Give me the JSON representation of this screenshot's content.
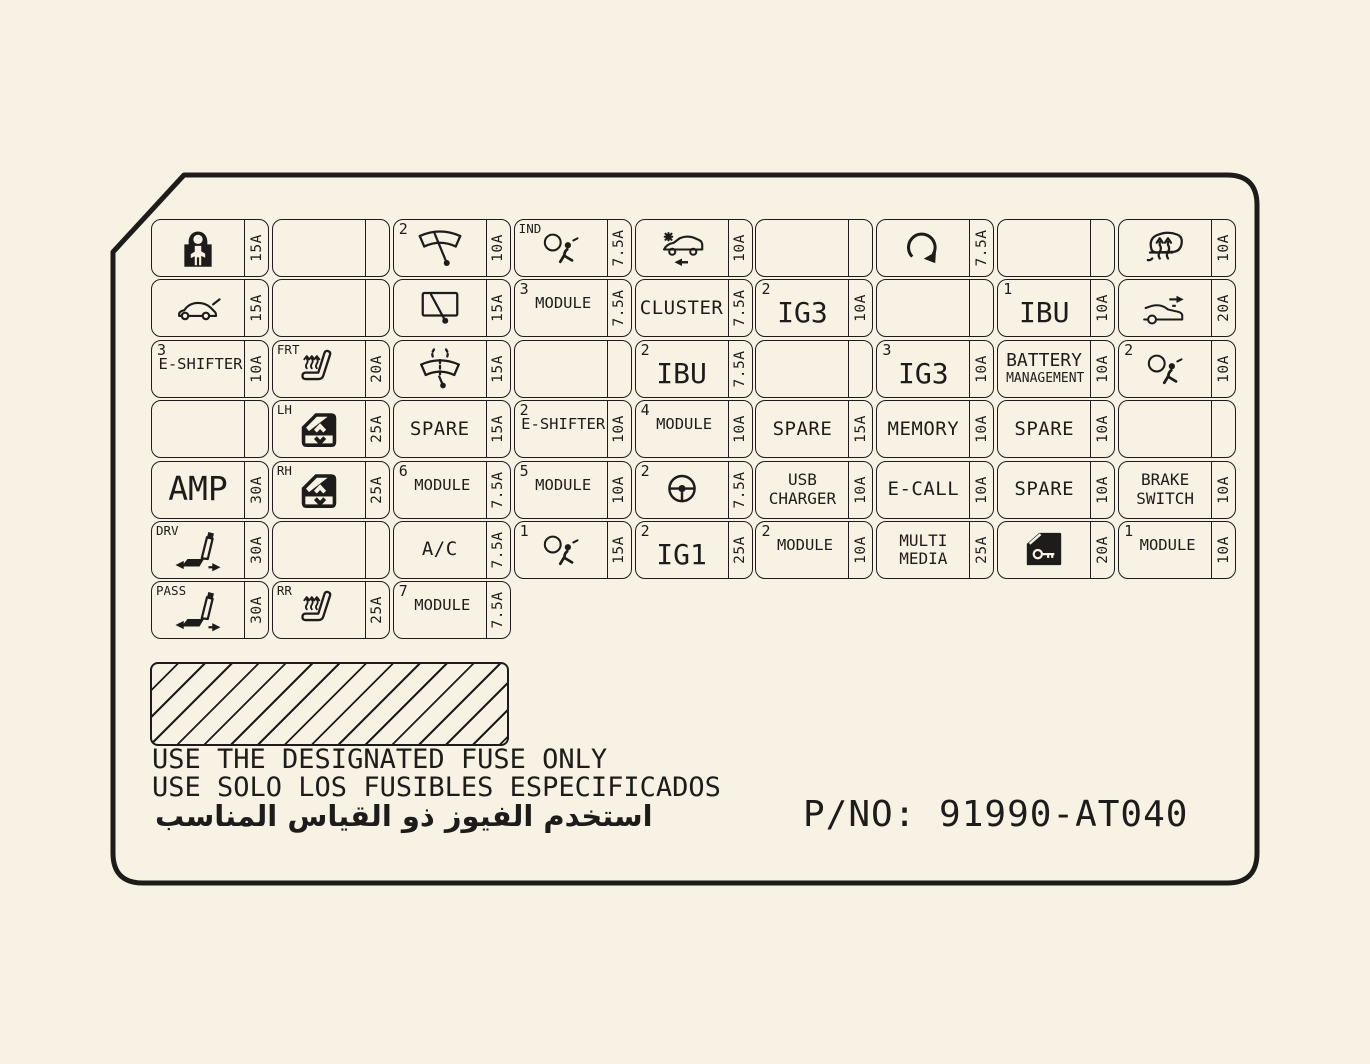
{
  "colors": {
    "background": "#f7f2e3",
    "ink": "#1d1c1a"
  },
  "notes": {
    "en": "USE THE DESIGNATED FUSE ONLY",
    "es": "USE SOLO LOS FUSIBLES ESPECIFICADOS",
    "ar": "استخدم الفيوز ذو القياس المناسب",
    "pno": "P/NO: 91990-AT040"
  },
  "grid": {
    "rows": [
      [
        {
          "icon": "child-lock",
          "amp": "15A"
        },
        {},
        {
          "icon": "wiper-front",
          "corner": "2",
          "amp": "10A"
        },
        {
          "icon": "airbag",
          "tag": "IND",
          "amp": "7.5A"
        },
        {
          "icon": "car-crash",
          "amp": "10A"
        },
        {},
        {
          "icon": "circular-arrow",
          "amp": "7.5A"
        },
        {},
        {
          "icon": "defrost-rear",
          "amp": "10A"
        }
      ],
      [
        {
          "icon": "car-tailgate",
          "amp": "15A"
        },
        {},
        {
          "icon": "wiper-rear",
          "amp": "15A"
        },
        {
          "corner": "3",
          "lines": [
            "MODULE"
          ],
          "variant": "sm",
          "amp": "7.5A"
        },
        {
          "lines": [
            "CLUSTER"
          ],
          "variant": "md",
          "amp": "7.5A"
        },
        {
          "corner": "2",
          "lines": [
            "IG3"
          ],
          "variant": "lg",
          "amp": "10A"
        },
        {},
        {
          "corner": "1",
          "lines": [
            "IBU"
          ],
          "variant": "lg",
          "amp": "10A"
        },
        {
          "icon": "car-arrow",
          "amp": "20A"
        }
      ],
      [
        {
          "corner": "3",
          "lines": [
            "E-SHIFTER"
          ],
          "variant": "sm",
          "amp": "10A"
        },
        {
          "icon": "seat-heated",
          "tag": "FRT",
          "amp": "20A"
        },
        {
          "icon": "washer",
          "amp": "15A"
        },
        {},
        {
          "corner": "2",
          "lines": [
            "IBU"
          ],
          "variant": "lg",
          "amp": "7.5A"
        },
        {},
        {
          "corner": "3",
          "lines": [
            "IG3"
          ],
          "variant": "lg",
          "amp": "10A"
        },
        {
          "lines": [
            "BATTERY",
            "MANAGEMENT"
          ],
          "variant": "bm",
          "amp": "10A"
        },
        {
          "icon": "airbag",
          "corner": "2",
          "amp": "10A"
        }
      ],
      [
        {},
        {
          "icon": "window-switch",
          "tag": "LH",
          "amp": "25A"
        },
        {
          "lines": [
            "SPARE"
          ],
          "variant": "md",
          "amp": "15A"
        },
        {
          "corner": "2",
          "lines": [
            "E-SHIFTER"
          ],
          "variant": "sm",
          "amp": "10A"
        },
        {
          "corner": "4",
          "lines": [
            "MODULE"
          ],
          "variant": "sm",
          "amp": "10A"
        },
        {
          "lines": [
            "SPARE"
          ],
          "variant": "md",
          "amp": "15A"
        },
        {
          "lines": [
            "MEMORY"
          ],
          "variant": "md",
          "amp": "10A"
        },
        {
          "lines": [
            "SPARE"
          ],
          "variant": "md",
          "amp": "10A"
        },
        {}
      ],
      [
        {
          "lines": [
            "AMP"
          ],
          "variant": "xl",
          "amp": "30A"
        },
        {
          "icon": "window-switch",
          "tag": "RH",
          "amp": "25A"
        },
        {
          "corner": "6",
          "lines": [
            "MODULE"
          ],
          "variant": "sm",
          "amp": "7.5A"
        },
        {
          "corner": "5",
          "lines": [
            "MODULE"
          ],
          "variant": "sm",
          "amp": "10A"
        },
        {
          "icon": "steering-wheel",
          "corner": "2",
          "amp": "7.5A"
        },
        {
          "lines": [
            "USB",
            "CHARGER"
          ],
          "variant": "sm2",
          "amp": "10A"
        },
        {
          "lines": [
            "E-CALL"
          ],
          "variant": "md",
          "amp": "10A"
        },
        {
          "lines": [
            "SPARE"
          ],
          "variant": "md",
          "amp": "10A"
        },
        {
          "lines": [
            "BRAKE",
            "SWITCH"
          ],
          "variant": "sm2",
          "amp": "10A"
        }
      ],
      [
        {
          "icon": "seat-power",
          "tag": "DRV",
          "amp": "30A"
        },
        {},
        {
          "lines": [
            "A/C"
          ],
          "variant": "md",
          "amp": "7.5A"
        },
        {
          "icon": "airbag",
          "corner": "1",
          "amp": "15A"
        },
        {
          "corner": "2",
          "lines": [
            "IG1"
          ],
          "variant": "lg",
          "amp": "25A"
        },
        {
          "corner": "2",
          "lines": [
            "MODULE"
          ],
          "variant": "sm",
          "amp": "10A"
        },
        {
          "lines": [
            "MULTI",
            "MEDIA"
          ],
          "variant": "sm2",
          "amp": "25A"
        },
        {
          "icon": "door-key",
          "amp": "20A"
        },
        {
          "corner": "1",
          "lines": [
            "MODULE"
          ],
          "variant": "sm",
          "amp": "10A"
        }
      ],
      [
        {
          "icon": "seat-power",
          "tag": "PASS",
          "amp": "30A"
        },
        {
          "icon": "seat-heated",
          "tag": "RR",
          "amp": "25A"
        },
        {
          "corner": "7",
          "lines": [
            "MODULE"
          ],
          "variant": "sm",
          "amp": "7.5A"
        },
        null,
        null,
        null,
        null,
        null,
        null
      ]
    ]
  }
}
